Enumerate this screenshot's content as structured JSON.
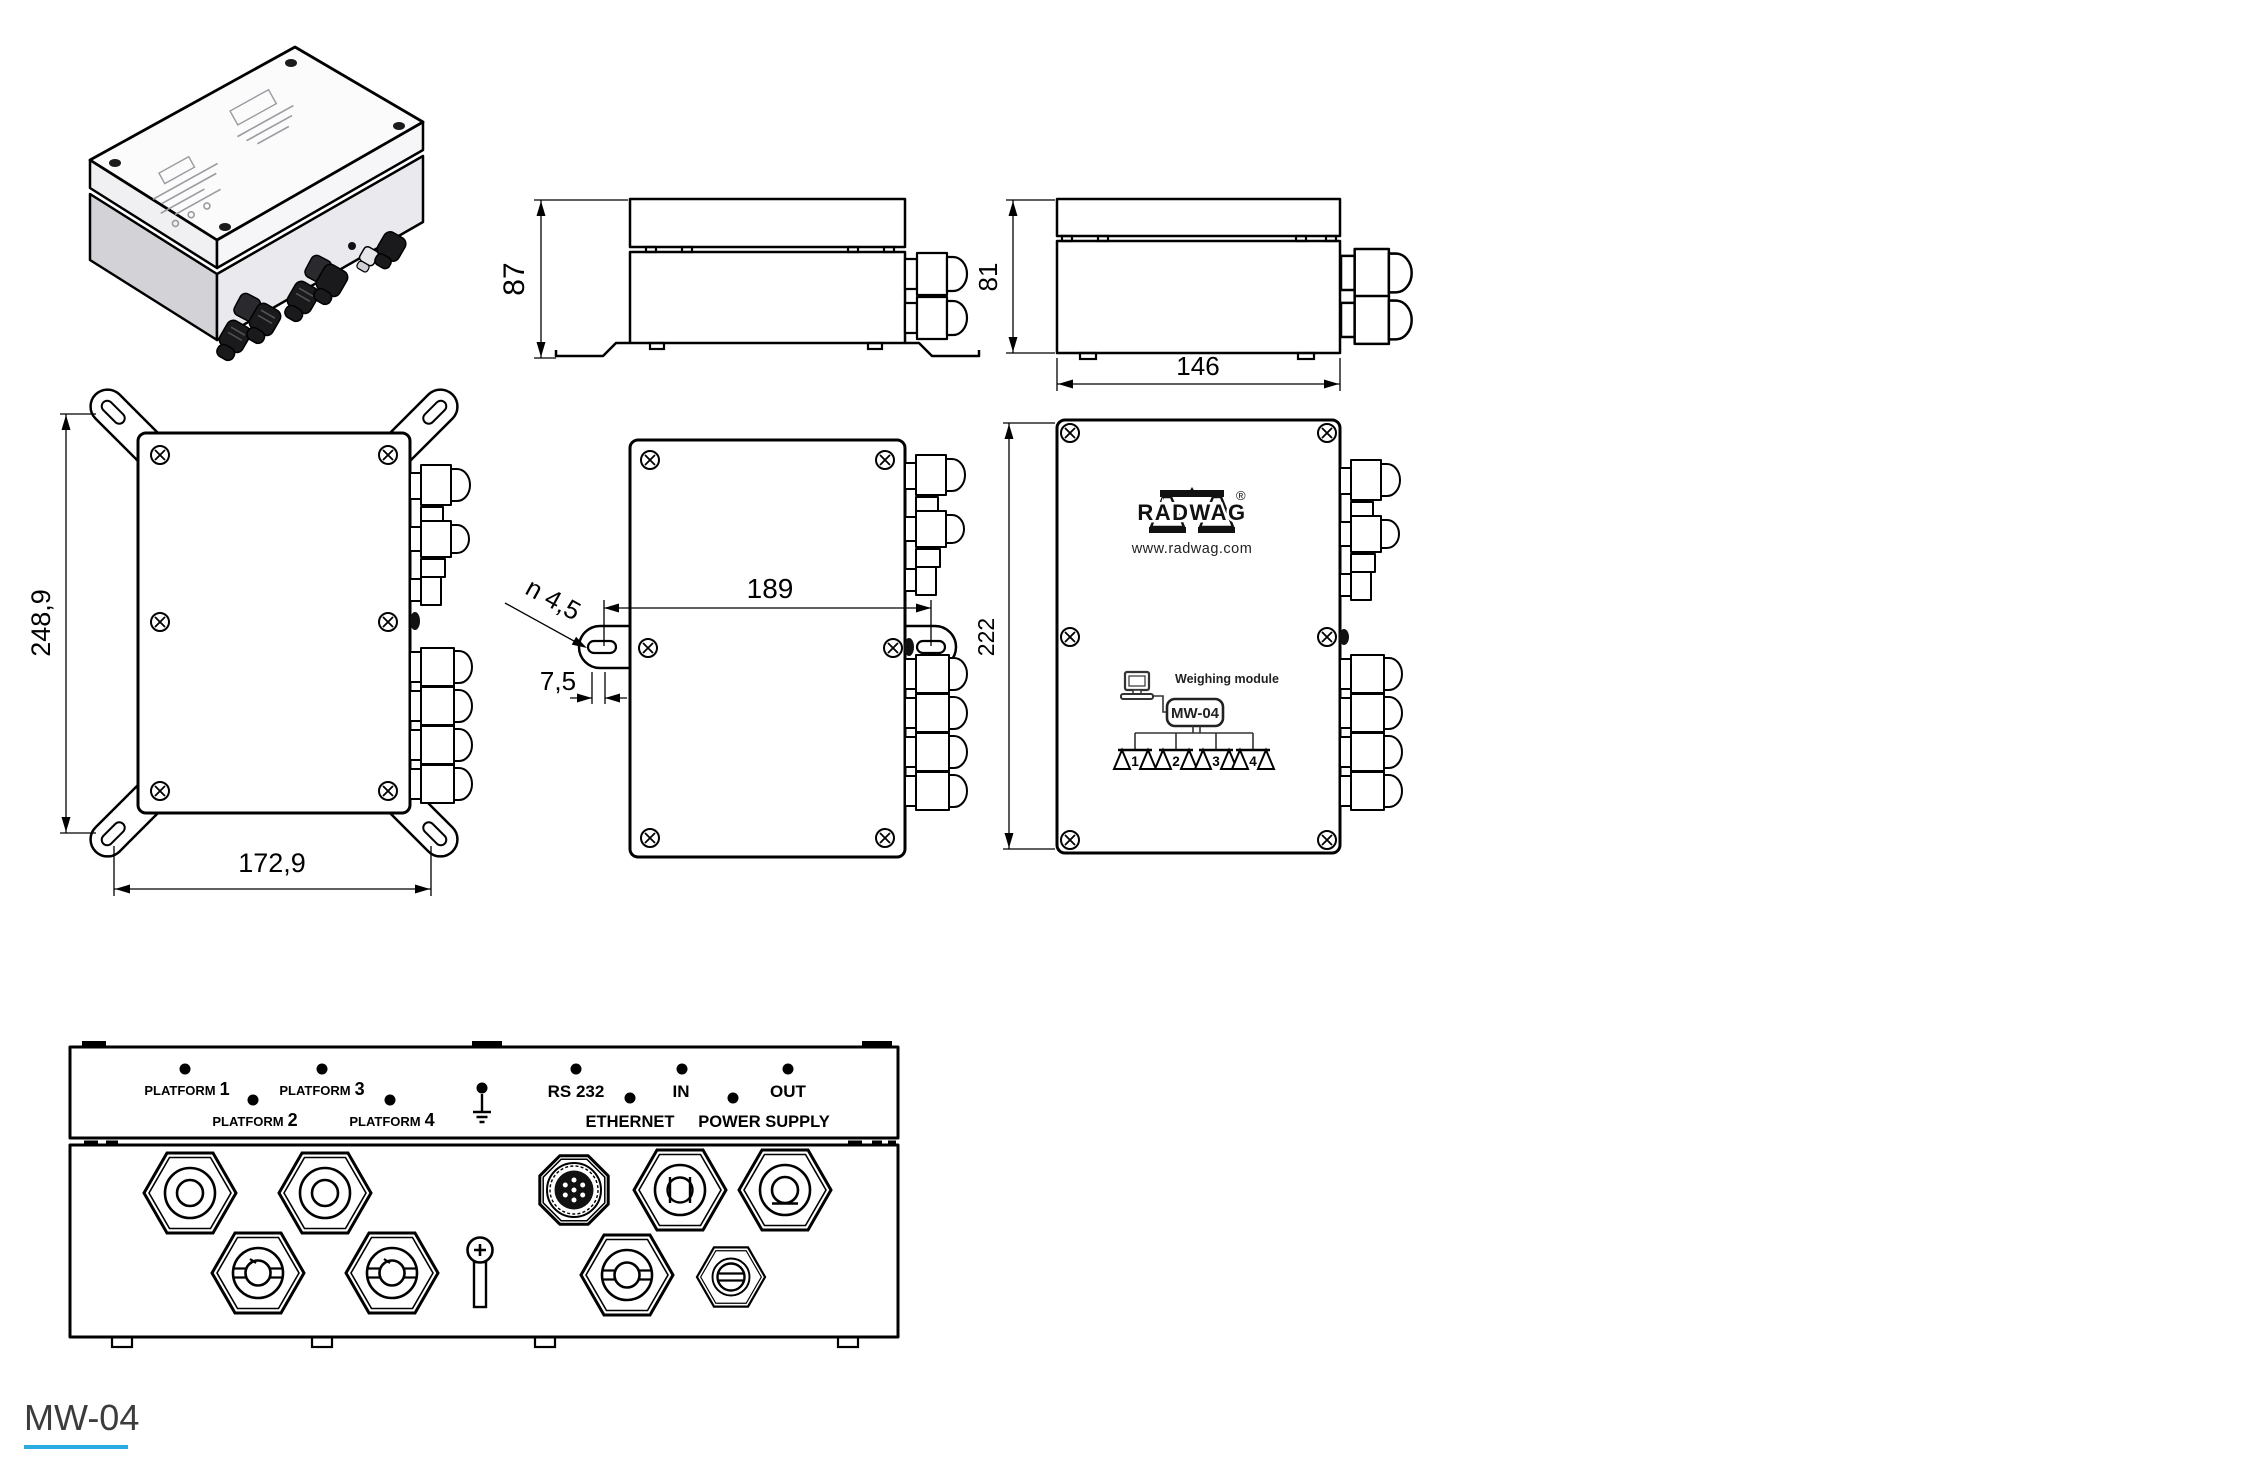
{
  "title": "MW-04 weighing module technical drawing",
  "footer": {
    "model": "MW-04"
  },
  "dims": {
    "top_height": "87",
    "side_height": "81",
    "side_width": "146",
    "back_depth": "248,9",
    "back_width": "172,9",
    "mount_spacing": "189",
    "hole": "n 4,5",
    "slot_offset": "7,5",
    "front_height": "222"
  },
  "logo": {
    "brand": "RADWAG",
    "registered": "®",
    "website": "www.radwag.com"
  },
  "diagram": {
    "caption": "Weighing module",
    "module": "MW-04",
    "platforms": [
      "1",
      "2",
      "3",
      "4"
    ]
  },
  "panel": {
    "platform_word": "PLATFORM",
    "platform_numbers": [
      "1",
      "2",
      "3",
      "4"
    ],
    "rs232": "RS 232",
    "ethernet": "ETHERNET",
    "input": "IN",
    "output": "OUT",
    "power": "POWER SUPPLY"
  },
  "colors": {
    "accent_underline": "#29ABE2"
  }
}
